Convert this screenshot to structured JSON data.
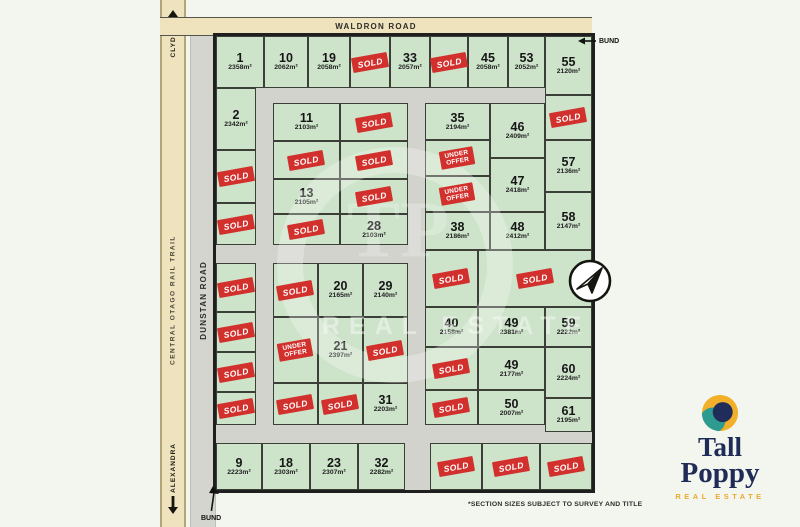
{
  "map": {
    "roads": {
      "waldron": "WALDRON ROAD",
      "dunstan": "DUNSTAN ROAD",
      "rail_trail": "CENTRAL OTAGO RAIL TRAIL",
      "clyde": "CLYDE",
      "alexandra": "ALEXANDRA"
    },
    "bund_top": "BUND",
    "bund_bottom": "BUND",
    "sold_label": "SOLD",
    "under_offer_lines": [
      "UNDER",
      "OFFER"
    ],
    "watermark_monogram": "TP",
    "watermark_text": "REAL ESTATE",
    "footnote": "*SECTION SIZES SUBJECT TO SURVEY AND TITLE",
    "colors": {
      "lot_green": "#cde3ca",
      "road_gray": "#d2d3cd",
      "road_beige": "#eee3bd",
      "sold_red": "#d2302c",
      "boundary": "#1f1f1f"
    },
    "lots": [
      {
        "id": "L1",
        "number": "1",
        "size": "2358m²",
        "status": "available"
      },
      {
        "id": "L10",
        "number": "10",
        "size": "2062m²",
        "status": "available"
      },
      {
        "id": "L19",
        "number": "19",
        "size": "2058m²",
        "status": "available"
      },
      {
        "id": "St1",
        "status": "sold"
      },
      {
        "id": "L33",
        "number": "33",
        "size": "2057m²",
        "status": "available"
      },
      {
        "id": "St2",
        "status": "sold"
      },
      {
        "id": "L45",
        "number": "45",
        "size": "2058m²",
        "status": "available"
      },
      {
        "id": "L53",
        "number": "53",
        "size": "2052m²",
        "status": "available"
      },
      {
        "id": "L55",
        "number": "55",
        "size": "2120m²",
        "status": "available"
      },
      {
        "id": "L2",
        "number": "2",
        "size": "2342m²",
        "status": "available"
      },
      {
        "id": "Sl1",
        "status": "sold"
      },
      {
        "id": "Sl2",
        "status": "sold"
      },
      {
        "id": "Sl3",
        "status": "sold"
      },
      {
        "id": "Sl4",
        "status": "sold"
      },
      {
        "id": "Sl5",
        "status": "sold"
      },
      {
        "id": "Sl6",
        "status": "sold"
      },
      {
        "id": "M11",
        "number": "11",
        "size": "2103m²",
        "status": "available"
      },
      {
        "id": "Sm1",
        "status": "sold"
      },
      {
        "id": "Sm2",
        "status": "sold"
      },
      {
        "id": "Sm3",
        "status": "sold"
      },
      {
        "id": "M13",
        "number": "13",
        "size": "2105m²",
        "status": "available"
      },
      {
        "id": "Sm4",
        "status": "sold"
      },
      {
        "id": "Sm5",
        "status": "sold"
      },
      {
        "id": "M28",
        "number": "28",
        "size": "2103m²",
        "status": "available"
      },
      {
        "id": "Sn1",
        "status": "sold"
      },
      {
        "id": "M20",
        "number": "20",
        "size": "2165m²",
        "status": "available"
      },
      {
        "id": "M29",
        "number": "29",
        "size": "2140m²",
        "status": "available"
      },
      {
        "id": "UO1",
        "status": "under-offer"
      },
      {
        "id": "M21",
        "number": "21",
        "size": "2397m²",
        "status": "available"
      },
      {
        "id": "Sn2",
        "status": "sold"
      },
      {
        "id": "Sn3",
        "status": "sold"
      },
      {
        "id": "Sn4",
        "status": "sold"
      },
      {
        "id": "M31",
        "number": "31",
        "size": "2203m²",
        "status": "available"
      },
      {
        "id": "R35",
        "number": "35",
        "size": "2194m²",
        "status": "available"
      },
      {
        "id": "UO2",
        "status": "under-offer"
      },
      {
        "id": "UO3",
        "status": "under-offer"
      },
      {
        "id": "R38",
        "number": "38",
        "size": "2186m²",
        "status": "available"
      },
      {
        "id": "R46",
        "number": "46",
        "size": "2409m²",
        "status": "available"
      },
      {
        "id": "R47",
        "number": "47",
        "size": "2418m²",
        "status": "available"
      },
      {
        "id": "R48",
        "number": "48",
        "size": "2412m²",
        "status": "available"
      },
      {
        "id": "Sf1",
        "status": "sold"
      },
      {
        "id": "R57",
        "number": "57",
        "size": "2136m²",
        "status": "available"
      },
      {
        "id": "R58",
        "number": "58",
        "size": "2147m²",
        "status": "available"
      },
      {
        "id": "Sr1",
        "status": "sold"
      },
      {
        "id": "Sr2",
        "status": "sold"
      },
      {
        "id": "R40",
        "number": "40",
        "size": "2158m²",
        "status": "available"
      },
      {
        "id": "R49a",
        "number": "49",
        "size": "2381m²",
        "status": "available"
      },
      {
        "id": "R59",
        "number": "59",
        "size": "2222m²",
        "status": "available"
      },
      {
        "id": "Sr3",
        "status": "sold"
      },
      {
        "id": "R49b",
        "number": "49",
        "size": "2177m²",
        "status": "available"
      },
      {
        "id": "R60",
        "number": "60",
        "size": "2224m²",
        "status": "available"
      },
      {
        "id": "Sr4",
        "status": "sold"
      },
      {
        "id": "R50",
        "number": "50",
        "size": "2007m²",
        "status": "available"
      },
      {
        "id": "R61",
        "number": "61",
        "size": "2195m²",
        "status": "available"
      },
      {
        "id": "L9",
        "number": "9",
        "size": "2223m²",
        "status": "available"
      },
      {
        "id": "L18",
        "number": "18",
        "size": "2303m²",
        "status": "available"
      },
      {
        "id": "L23",
        "number": "23",
        "size": "2307m²",
        "status": "available"
      },
      {
        "id": "L32",
        "number": "32",
        "size": "2282m²",
        "status": "available"
      },
      {
        "id": "Sb1",
        "status": "sold"
      },
      {
        "id": "Sb2",
        "status": "sold"
      },
      {
        "id": "Sb3",
        "status": "sold"
      }
    ]
  },
  "logo": {
    "line1": "Tall",
    "line2": "Poppy",
    "tagline": "REAL ESTATE"
  }
}
